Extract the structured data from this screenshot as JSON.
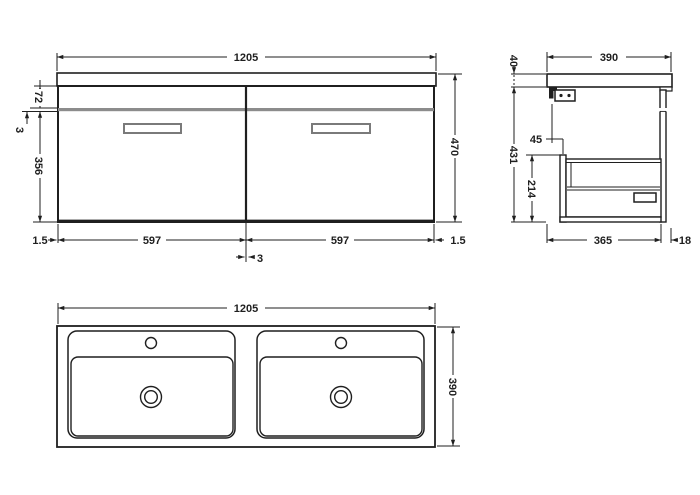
{
  "drawing_title": "Wall-hung double basin vanity unit dimension drawing",
  "views": {
    "front": {
      "label": "front-elevation",
      "dims": {
        "overall_width": "1205",
        "overall_height": "470",
        "top_band_height": "72",
        "gap_left": "3",
        "drawer_front_height": "356",
        "left_margin": "1.5",
        "left_drawer_width": "597",
        "right_drawer_width": "597",
        "right_margin": "1.5",
        "center_gap": "3"
      }
    },
    "side": {
      "label": "side-section",
      "dims": {
        "overall_depth": "390",
        "worktop_thickness": "40",
        "carcass_height": "431",
        "back_clearance": "45",
        "drawer_box_height": "214",
        "carcass_depth": "365",
        "front_overhang": "18"
      }
    },
    "plan": {
      "label": "basin-plan",
      "dims": {
        "overall_width": "1205",
        "overall_depth": "390"
      }
    }
  },
  "colors": {
    "line": "#1f1f1f",
    "gap_band": "#8c8c8c",
    "handle_stroke": "#7a7a7a",
    "background": "#ffffff"
  }
}
